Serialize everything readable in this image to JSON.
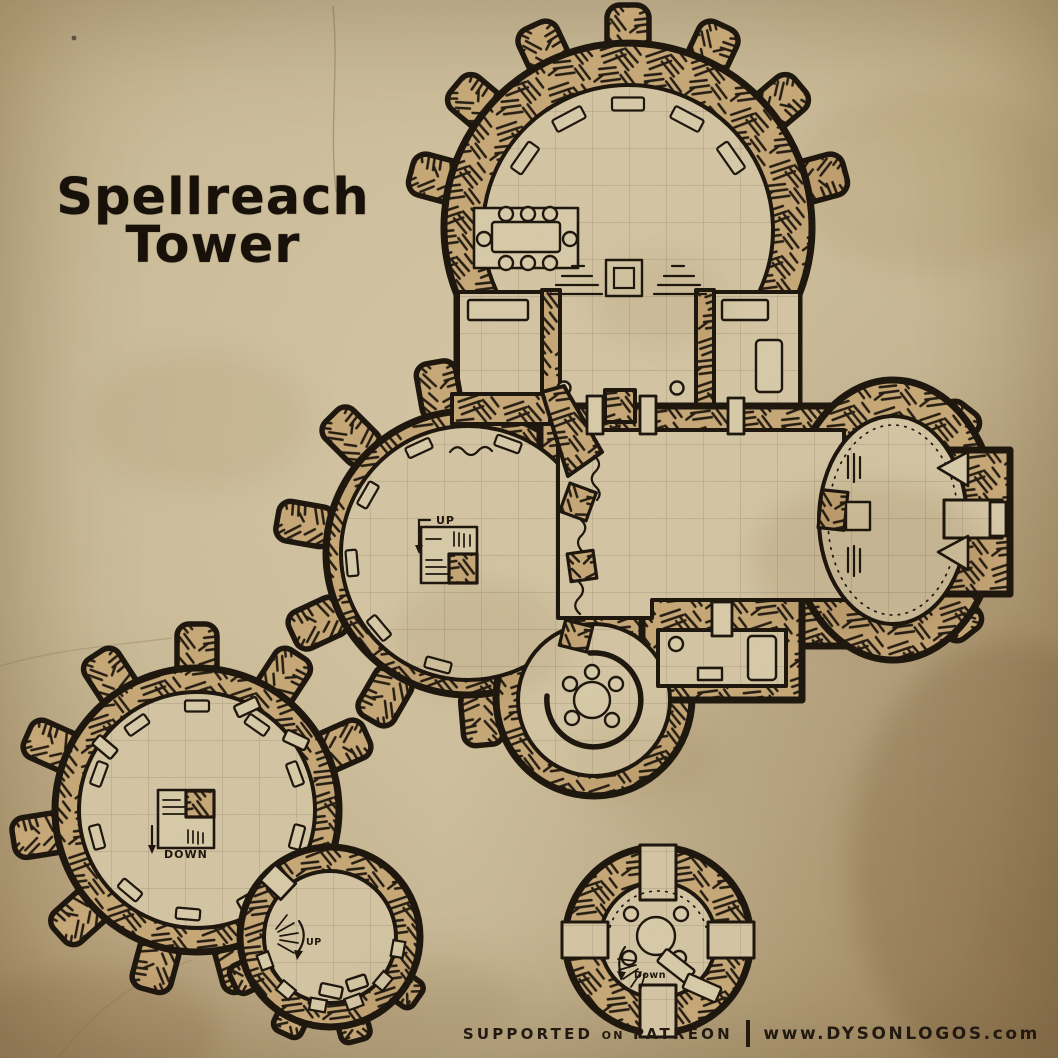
{
  "title": {
    "line1": "Spellreach",
    "line2": "Tower"
  },
  "footer": {
    "supported": "SUPPORTED",
    "on": "ON",
    "patreon": "PATREON",
    "url": "www.DYSONLOGOS.com"
  },
  "map": {
    "labels": {
      "main_up": "UP",
      "lower_down": "DOWN",
      "annex_up": "UP",
      "roof_down": "Down"
    },
    "colors": {
      "parchment": "#cbbc99",
      "floor": "#d4c6a4",
      "wall_fill": "#c7a877",
      "ink": "#1a130b",
      "grid_line": "#877a61"
    }
  }
}
